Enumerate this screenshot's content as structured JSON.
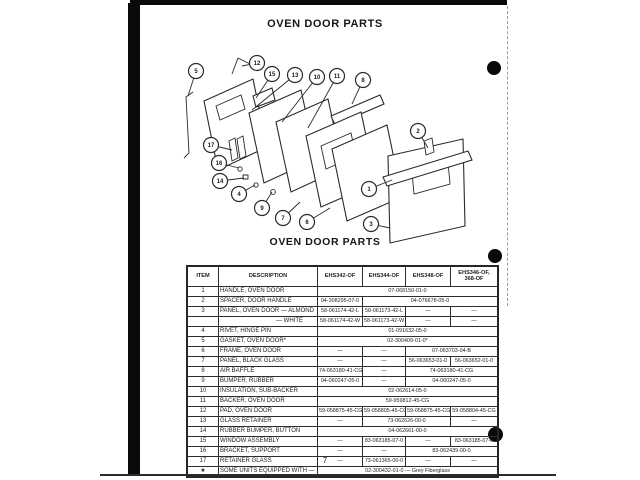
{
  "page": {
    "title_top": "OVEN DOOR PARTS",
    "title_table": "OVEN DOOR PARTS",
    "page_number": "7"
  },
  "diagram": {
    "callouts": [
      {
        "n": "5",
        "cx": 56,
        "cy": 26,
        "tx": 48,
        "ty": 51
      },
      {
        "n": "12",
        "cx": 117,
        "cy": 18,
        "tx": 102,
        "ty": 21
      },
      {
        "n": "15",
        "cx": 132,
        "cy": 29,
        "tx": 116,
        "ty": 53
      },
      {
        "n": "13",
        "cx": 155,
        "cy": 30,
        "tx": 112,
        "ty": 65
      },
      {
        "n": "10",
        "cx": 177,
        "cy": 32,
        "tx": 142,
        "ty": 77
      },
      {
        "n": "11",
        "cx": 197,
        "cy": 31,
        "tx": 168,
        "ty": 83
      },
      {
        "n": "8",
        "cx": 223,
        "cy": 35,
        "tx": 212,
        "ty": 59
      },
      {
        "n": "17",
        "cx": 71,
        "cy": 100,
        "tx": 92,
        "ty": 105
      },
      {
        "n": "16",
        "cx": 79,
        "cy": 118,
        "tx": 99,
        "ty": 123
      },
      {
        "n": "14",
        "cx": 80,
        "cy": 136,
        "tx": 104,
        "ty": 133
      },
      {
        "n": "4",
        "cx": 99,
        "cy": 149,
        "tx": 115,
        "ty": 140
      },
      {
        "n": "9",
        "cx": 122,
        "cy": 163,
        "tx": 132,
        "ty": 147
      },
      {
        "n": "7",
        "cx": 143,
        "cy": 173,
        "tx": 160,
        "ty": 157
      },
      {
        "n": "6",
        "cx": 167,
        "cy": 177,
        "tx": 190,
        "ty": 163
      },
      {
        "n": "1",
        "cx": 229,
        "cy": 144,
        "tx": 252,
        "ty": 135
      },
      {
        "n": "2",
        "cx": 278,
        "cy": 86,
        "tx": 288,
        "ty": 103
      },
      {
        "n": "3",
        "cx": 231,
        "cy": 179,
        "tx": 250,
        "ty": 183
      }
    ]
  },
  "table": {
    "headers": [
      "ITEM",
      "DESCRIPTION",
      "EHS342-OF",
      "EHS344-OF",
      "EHS348-OF",
      "EHS346-OF,\n368-OF"
    ],
    "rows": [
      {
        "item": "1",
        "desc": "HANDLE, OVEN DOOR",
        "indent": false,
        "cells": [
          {
            "text": "07-068150-01-0",
            "span": 4
          }
        ]
      },
      {
        "item": "2",
        "desc": "SPACER, DOOR HANDLE",
        "indent": false,
        "cells": [
          {
            "text": "04-308295-07-0",
            "span": 1
          },
          {
            "text": "04-076678-05-0",
            "span": 3
          }
        ]
      },
      {
        "item": "3",
        "desc": "PANEL, OVEN DOOR — ALMOND",
        "indent": false,
        "cells": [
          {
            "text": "58-061174-42-L",
            "span": 1
          },
          {
            "text": "58-061173-42-L",
            "span": 1
          },
          {
            "text": "—",
            "span": 1
          },
          {
            "text": "—",
            "span": 1
          }
        ]
      },
      {
        "item": "",
        "desc": "— WHITE",
        "indent": true,
        "cells": [
          {
            "text": "58-061174-42-W",
            "span": 1
          },
          {
            "text": "58-061173-42-W",
            "span": 1
          },
          {
            "text": "—",
            "span": 1
          },
          {
            "text": "—",
            "span": 1
          }
        ]
      },
      {
        "item": "4",
        "desc": "RIVET, HINGE PIN",
        "indent": false,
        "cells": [
          {
            "text": "01-091632-05-0",
            "span": 4
          }
        ]
      },
      {
        "item": "5",
        "desc": "GASKET, OVEN DOOR*",
        "indent": false,
        "cells": [
          {
            "text": "02-300409-01-0*",
            "span": 4
          }
        ]
      },
      {
        "item": "6",
        "desc": "FRAME, OVEN DOOR",
        "indent": false,
        "cells": [
          {
            "text": "—",
            "span": 1
          },
          {
            "text": "—",
            "span": 1
          },
          {
            "text": "07-063703-04-B",
            "span": 2
          }
        ]
      },
      {
        "item": "7",
        "desc": "PANEL, BLACK GLASS",
        "indent": false,
        "cells": [
          {
            "text": "—",
            "span": 1
          },
          {
            "text": "—",
            "span": 1
          },
          {
            "text": "56-063653-01-0",
            "span": 1
          },
          {
            "text": "56-063652-01-0",
            "span": 1
          }
        ]
      },
      {
        "item": "8",
        "desc": "AIR BAFFLE",
        "indent": false,
        "cells": [
          {
            "text": "74-063180-41-CG",
            "span": 1
          },
          {
            "text": "—",
            "span": 1
          },
          {
            "text": "74-063180-41-CG",
            "span": 2
          }
        ]
      },
      {
        "item": "9",
        "desc": "BUMPER, RUBBER",
        "indent": false,
        "cells": [
          {
            "text": "04-060247-05-0",
            "span": 1
          },
          {
            "text": "—",
            "span": 1
          },
          {
            "text": "04-060247-05-0",
            "span": 2
          }
        ]
      },
      {
        "item": "10",
        "desc": "INSULATION, SUB-BACKER",
        "indent": false,
        "cells": [
          {
            "text": "02-062614-05-0",
            "span": 4
          }
        ]
      },
      {
        "item": "11",
        "desc": "BACKER, OVEN DOOR",
        "indent": false,
        "cells": [
          {
            "text": "59-959812-45-CG",
            "span": 4
          }
        ]
      },
      {
        "item": "12",
        "desc": "PAD, OVEN DOOR",
        "indent": false,
        "cells": [
          {
            "text": "59-058875-45-CG",
            "span": 1
          },
          {
            "text": "59-058805-45-CG",
            "span": 1
          },
          {
            "text": "59-058875-45-CG",
            "span": 1
          },
          {
            "text": "59-058804-45-CG",
            "span": 1
          }
        ]
      },
      {
        "item": "13",
        "desc": "GLASS RETAINER",
        "indent": false,
        "cells": [
          {
            "text": "—",
            "span": 1
          },
          {
            "text": "73-062626-00-0",
            "span": 2
          },
          {
            "text": "—",
            "span": 1
          }
        ]
      },
      {
        "item": "14",
        "desc": "RUBBER BUMPER, BUTTON",
        "indent": false,
        "cells": [
          {
            "text": "04-062661-00-0",
            "span": 4
          }
        ]
      },
      {
        "item": "15",
        "desc": "WINDOW ASSEMBLY",
        "indent": false,
        "cells": [
          {
            "text": "—",
            "span": 1
          },
          {
            "text": "83-063185-07-0",
            "span": 1
          },
          {
            "text": "—",
            "span": 1
          },
          {
            "text": "83-063185-07-0",
            "span": 1
          }
        ]
      },
      {
        "item": "16",
        "desc": "BRACKET, SUPPORT",
        "indent": false,
        "cells": [
          {
            "text": "—",
            "span": 1
          },
          {
            "text": "—",
            "span": 1
          },
          {
            "text": "83-062439-00-0",
            "span": 2
          }
        ]
      },
      {
        "item": "17",
        "desc": "RETAINER GLASS",
        "indent": false,
        "cells": [
          {
            "text": "—",
            "span": 1
          },
          {
            "text": "73-061365-00-0",
            "span": 1
          },
          {
            "text": "—",
            "span": 1
          },
          {
            "text": "—",
            "span": 1
          }
        ]
      },
      {
        "item": "★",
        "desc": "SOME UNITS EQUIPPED WITH —",
        "indent": false,
        "cells": [
          {
            "text": "02-300432-01-0 — Grey Fiberglass",
            "span": 4
          }
        ]
      }
    ]
  }
}
